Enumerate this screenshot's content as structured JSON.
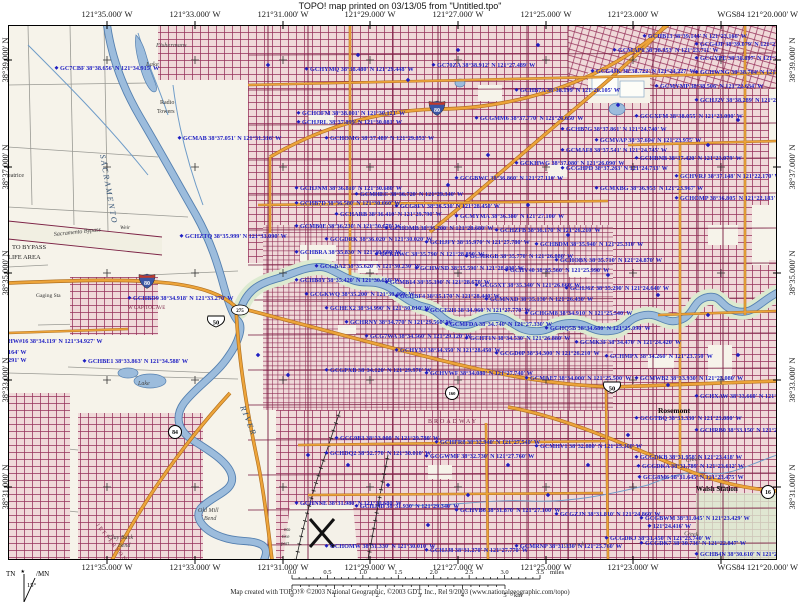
{
  "header": {
    "title": "TOPO! map printed on 03/13/05 from \"Untitled.tpo\""
  },
  "coordinates": {
    "top_longitudes": [
      "121°35.000' W",
      "121°33.000' W",
      "121°31.000' W",
      "121°29.000' W",
      "121°27.000' W",
      "121°25.000' W",
      "121°23.000' W",
      "WGS84 121°20.000' W"
    ],
    "bottom_longitudes": [
      "121°35.000' W",
      "121°33.000' W",
      "121°31.000' W",
      "121°29.000' W",
      "121°27.000' W",
      "121°25.000' W",
      "121°23.000' W",
      "WGS84 121°20.000' W"
    ],
    "left_latitudes": [
      "38°39.000' N",
      "38°37.000' N",
      "38°35.000' N",
      "38°33.000' N",
      "38°31.000' N"
    ],
    "right_latitudes": [
      "38°39.000' N",
      "38°37.000' N",
      "38°35.000' N",
      "38°33.000' N",
      "38°31.000' N"
    ]
  },
  "scale_bar": {
    "miles_ticks": [
      "0.0",
      "0.5",
      "1.0",
      "1.5",
      "2.0",
      "2.5",
      "3.0",
      "3.5"
    ],
    "miles_unit": "miles",
    "km_ticks": [
      "0",
      "1",
      "2",
      "3",
      "4",
      "5"
    ],
    "km_unit": "km"
  },
  "declination": {
    "tn": "TN",
    "mn": "MN",
    "angle": "15°",
    "star": "★"
  },
  "footer": {
    "credit": "Map created with TOPO!® ©2003 National Geographic, ©2003 GDT, Inc., Rel 9/2003 (www.nationalgeographic.com/topo)"
  },
  "colors": {
    "paper": "#ffffff",
    "map_base": "#f6f3ea",
    "urban_pink": "#f0d9d9",
    "street_maroon": "#96315a",
    "arterial_maroon": "#7c2245",
    "highway_orange": "#eda43a",
    "highway_casing": "#b07020",
    "water_blue": "#9cbcdc",
    "water_edge": "#5580b0",
    "green_area": "#dcead0",
    "waypoint_blue": "#1e1ec2",
    "interstate_blue": "#3a55a4",
    "interstate_red": "#c0392b"
  },
  "map": {
    "route_shields": [
      [
        "interstate",
        "80",
        139,
        256
      ],
      [
        "interstate",
        "80",
        429,
        83
      ],
      [
        "us",
        "50",
        208,
        297
      ],
      [
        "us",
        "50",
        604,
        363
      ],
      [
        "oval",
        "275",
        232,
        285
      ],
      [
        "circle",
        "84",
        167,
        407
      ],
      [
        "circle",
        "160",
        444,
        368
      ],
      [
        "circle",
        "16",
        760,
        467
      ]
    ],
    "place_labels": [
      [
        "Fishermans",
        148,
        22,
        6.5,
        0,
        "#444",
        "i"
      ],
      [
        "Lake",
        138,
        41,
        6.5,
        0,
        "#444",
        "i"
      ],
      [
        "Radio",
        152,
        79,
        6,
        0,
        "#333",
        ""
      ],
      [
        "Towers",
        149,
        88,
        6,
        0,
        "#333",
        ""
      ],
      [
        "SACRAMENTO",
        92,
        130,
        8,
        80,
        "#2f4f73",
        "isp"
      ],
      [
        "RIVER",
        232,
        382,
        8,
        68,
        "#2f4f73",
        "isp"
      ],
      [
        "Sacramento Bypass",
        46,
        211,
        6,
        -6,
        "#333",
        "i"
      ],
      [
        "Weir",
        112,
        204,
        5.5,
        0,
        "#333",
        "i"
      ],
      [
        "TO BYPASS",
        4,
        224,
        6.5,
        0,
        "#222",
        ""
      ],
      [
        "LIFE AREA",
        0,
        234,
        6.5,
        0,
        "#222",
        ""
      ],
      [
        "Gaging Sta",
        28,
        272,
        5.5,
        0,
        "#333",
        ""
      ],
      [
        "eatrice",
        0,
        152,
        6,
        0,
        "#333",
        ""
      ],
      [
        "W CAPITOL AVE",
        120,
        284,
        5,
        0,
        "#7c2245",
        ""
      ],
      [
        "BROADWAY",
        420,
        398,
        6,
        0,
        "#7c2245",
        "sp"
      ],
      [
        "JEFFERSON",
        88,
        500,
        5.5,
        52,
        "#7c2245",
        "sp"
      ],
      [
        "Rosemont",
        650,
        388,
        7.5,
        0,
        "#111",
        "b"
      ],
      [
        "Walsh Station",
        688,
        466,
        7,
        0,
        "#111",
        "b"
      ],
      [
        "Creek",
        678,
        437,
        6,
        -8,
        "#444",
        "i"
      ],
      [
        "Creek",
        676,
        510,
        6,
        6,
        "#444",
        "i"
      ],
      [
        "C r e e k",
        556,
        522,
        6,
        -4,
        "#444",
        "i"
      ],
      [
        "Clay Bank",
        100,
        514,
        6,
        0,
        "#444",
        "i"
      ],
      [
        "Bend",
        110,
        522,
        6,
        0,
        "#444",
        "i"
      ],
      [
        "Old Mill",
        190,
        487,
        6,
        0,
        "#444",
        "i"
      ],
      [
        "Bend",
        196,
        495,
        6,
        0,
        "#444",
        "i"
      ],
      [
        "Lake",
        130,
        360,
        6,
        0,
        "#444",
        "i"
      ],
      [
        "nto",
        276,
        506,
        5,
        0,
        "#333",
        ""
      ],
      [
        "tive",
        274,
        513,
        5,
        0,
        "#333",
        ""
      ],
      [
        "port",
        273,
        520,
        5,
        0,
        "#333",
        ""
      ]
    ],
    "waypoints": [
      [
        52,
        45,
        "GC7CBF 38°38.656' N 121°34.915' W"
      ],
      [
        175,
        115,
        "GCMAB 38°37.051' N 121°31.316' W"
      ],
      [
        302,
        46,
        "GCHYMQ 38°38.480' N 121°29.448' W"
      ],
      [
        429,
        42,
        "GC70ZA 38°38.912' N 121°27.489' W"
      ],
      [
        294,
        90,
        "GCHOFM 38°38.001' N 121°30.121' W"
      ],
      [
        294,
        99,
        "GCHJRL 38°37.899' N 121°30.081' W"
      ],
      [
        322,
        115,
        "GCHOMG 38°37.489' N 121°29.853' W"
      ],
      [
        640,
        13,
        "GCHB13 38°39.144' N 121°23.166' W"
      ],
      [
        692,
        21,
        "GCG4JP 38°39.079' N 121°21.775' W"
      ],
      [
        610,
        27,
        "GCMAP6 38°38.953' N 121°23.711' W"
      ],
      [
        692,
        35,
        "GCGYPE 38°38.897' N 121°21.702' W"
      ],
      [
        588,
        48,
        "GCG4JK 38°38.722' N 121°24.227' W"
      ],
      [
        692,
        49,
        "GCHWNG 38°38.704' N 121°21.693' W"
      ],
      [
        652,
        63,
        "GCMYMP 38°38.506' N 121°22.634' W"
      ],
      [
        692,
        77,
        "GCHJ2V 38°38.289' N 121°21.680' W"
      ],
      [
        632,
        93,
        "GCGXFM 38°38.055' N 121°23.090' W"
      ],
      [
        558,
        106,
        "GCHB7G 38°37.861' N 121°24.740' W"
      ],
      [
        592,
        117,
        "GCMVAP 38°37.694' N 121°23.975' W"
      ],
      [
        558,
        127,
        "GCMAF8 38°37.541' N 121°24.745' W"
      ],
      [
        632,
        135,
        "GCHRNB 38°37.420' N 121°23.079' W"
      ],
      [
        558,
        145,
        "GCGHPD 38°37.263' N 121°24.733' W"
      ],
      [
        672,
        153,
        "GCHVRJ 38°37.148' N 121°22.170' W"
      ],
      [
        592,
        165,
        "GCMXBG 38°36.953' N 121°23.967' W"
      ],
      [
        672,
        175,
        "GCHOMP 38°36.805' N 121°22.183' W"
      ],
      [
        512,
        67,
        "GCHB7A 38°38.199' N 121°26.105' W"
      ],
      [
        472,
        95,
        "GCGMM6 38°37.770' N 121°26.650' W"
      ],
      [
        512,
        140,
        "GCKHWG 38°37.080' N 121°26.090' W"
      ],
      [
        452,
        155,
        "GCGBWC 38°36.860' N 121°27.110' W"
      ],
      [
        292,
        165,
        "GCHJNM 38°36.810' N 121°30.680' W"
      ],
      [
        352,
        171,
        "GCMHEC 38°36.720' N 121°29.340' W"
      ],
      [
        292,
        180,
        "GCHB7D 38°36.580' N 121°30.660' W"
      ],
      [
        392,
        183,
        "GCG8FV 38°36.530' N 121°28.450' W"
      ],
      [
        332,
        191,
        "GCHARB 38°36.410' N 121°29.790' W"
      ],
      [
        452,
        193,
        "GCMYMA 38°36.380' N 121°27.100' W"
      ],
      [
        292,
        203,
        "GCMB0E 38°36.230' N 121°30.670' W"
      ],
      [
        382,
        205,
        "GCHOMB 38°36.200' N 121°28.680' W"
      ],
      [
        492,
        207,
        "GCHZFB 38°36.170' N 121°26.210' W"
      ],
      [
        322,
        216,
        "GCGDRK 38°36.020' N 121°30.020' W"
      ],
      [
        422,
        219,
        "GCHJFY 38°35.970' N 121°27.780' W"
      ],
      [
        532,
        221,
        "GCHBDM 38°35.940' N 121°25.310' W"
      ],
      [
        292,
        229,
        "GCHBRA 38°35.830' N 121°30.680' W"
      ],
      [
        372,
        231,
        "GCKHWC 38°35.790' N 121°28.890' W"
      ],
      [
        462,
        233,
        "GCMRGB 38°35.770' N 121°26.880' W"
      ],
      [
        552,
        237,
        "GCHOBX 38°35.710' N 121°24.870' W"
      ],
      [
        312,
        243,
        "GCGBA2 38°35.620' N 121°30.230' W"
      ],
      [
        412,
        245,
        "GCHWND 38°35.590' N 121°28.000' W"
      ],
      [
        502,
        247,
        "GCHV40 38°35.560' N 121°25.990' W"
      ],
      [
        292,
        257,
        "GCHB8Y 38°35.420' N 121°30.690' W"
      ],
      [
        382,
        259,
        "GCMB14 38°35.390' N 121°28.670' W"
      ],
      [
        472,
        262,
        "GCG5XT 38°35.340' N 121°26.660' W"
      ],
      [
        562,
        265,
        "GCHJ6Z 38°35.290' N 121°24.640' W"
      ],
      [
        302,
        271,
        "GCGKWQ 38°35.200' N 121°30.460' W"
      ],
      [
        392,
        273,
        "GCHBF4 38°35.170' N 121°28.440' W"
      ],
      [
        482,
        276,
        "GCMNXD 38°35.130' N 121°26.430' W"
      ],
      [
        322,
        285,
        "GCHEX2 38°34.990' N 121°30.010' W"
      ],
      [
        422,
        287,
        "GCGE2H 38°34.960' N 121°27.770' W"
      ],
      [
        522,
        290,
        "GCHGM8 38°34.910' N 121°25.540' W"
      ],
      [
        342,
        299,
        "GCHRNY 38°34.770' N 121°29.560' W"
      ],
      [
        442,
        301,
        "GCMFDA 38°34.740' N 121°27.330' W"
      ],
      [
        542,
        305,
        "GCHQ5B 38°34.680' N 121°25.090' W"
      ],
      [
        362,
        313,
        "GCG7WA 38°34.560' N 121°29.120' W"
      ],
      [
        462,
        315,
        "GCHT1N 38°34.530' N 121°26.880' W"
      ],
      [
        572,
        319,
        "GCMK3F 38°34.470' N 121°24.420' W"
      ],
      [
        392,
        327,
        "GCHYNJ 38°34.350' N 121°28.450' W"
      ],
      [
        492,
        330,
        "GCGD0P 38°34.300' N 121°26.210' W"
      ],
      [
        602,
        333,
        "GCHMPX 38°34.260' N 121°23.750' W"
      ],
      [
        125,
        275,
        "GCHBD9 38°34.918' N 121°33.270' W"
      ],
      [
        0,
        318,
        "HW#16 38°34.119' N 121°34.927' W"
      ],
      [
        0,
        329,
        "164' W"
      ],
      [
        0,
        337,
        "291' W"
      ],
      [
        80,
        338,
        "GCHBE1 38°33.863' N 121°34.588' W"
      ],
      [
        177,
        213,
        "GCHZTQ 38°35.999' N 121°33.090' W"
      ],
      [
        322,
        347,
        "GCGPXB 38°34.120' N 121°29.970' W"
      ],
      [
        422,
        350,
        "GCHVWF 38°34.080' N 121°27.740' W"
      ],
      [
        522,
        355,
        "GCMAE7 38°34.000' N 121°25.500' W"
      ],
      [
        332,
        415,
        "GCG9B3 38°33.000' N 121°29.780' W"
      ],
      [
        432,
        419,
        "GCHFR8 38°32.940' N 121°27.540' W"
      ],
      [
        532,
        423,
        "GCMHV1 38°32.880' N 121°25.300' W"
      ],
      [
        322,
        430,
        "GCHDQ2 38°32.770' N 121°30.010' W"
      ],
      [
        422,
        433,
        "GCGWMF 38°32.730' N 121°27.760' W"
      ],
      [
        292,
        480,
        "GCHNNE 38°31.980' N 121°30.680' W"
      ],
      [
        352,
        483,
        "GCHJ4D 38°31.930' N 121°29.340' W"
      ],
      [
        452,
        487,
        "GCHVB6 38°31.870' N 121°27.100' W"
      ],
      [
        552,
        491,
        "GCGZJN 38°31.810' N 121°24.860' W"
      ],
      [
        322,
        523,
        "GCHOMW 38°31.330' N 121°30.010' W"
      ],
      [
        422,
        527,
        "GCHJJ8 38°31.270' N 121°27.770' W"
      ],
      [
        512,
        523,
        "GCMRNP 38°31.330' N 121°25.760' W"
      ],
      [
        602,
        515,
        "GCGDKJ 38°31.450' N 121°23.740' W"
      ],
      [
        632,
        355,
        "GCMWB2 38°33.930' N 121°23.080' W"
      ],
      [
        692,
        373,
        "GCHXAW 38°33.660' N 121°21.740' W"
      ],
      [
        632,
        395,
        "GCGTBQ 38°33.330' N 121°23.080' W"
      ],
      [
        692,
        407,
        "GCHRB0 38°33.150' N 121°21.740' W"
      ],
      [
        632,
        434,
        "GCGDKB 38°31.958' N 121°23.418' W"
      ],
      [
        634,
        443,
        "GCGDKA 38°31.789' N 121°23.612' W"
      ],
      [
        635,
        454,
        "GCG8M6 38°31.645' N 121°23.475' W"
      ],
      [
        637,
        495,
        "GCGBWM 38°31.045' N 121°23.429' W"
      ],
      [
        645,
        503,
        "121°24.416' W"
      ],
      [
        637,
        520,
        "GCGDK7 38°30.736' N 121°22.847' W"
      ],
      [
        692,
        531,
        "GCHB4N 38°30.610' N 121°21.740' W"
      ]
    ]
  }
}
